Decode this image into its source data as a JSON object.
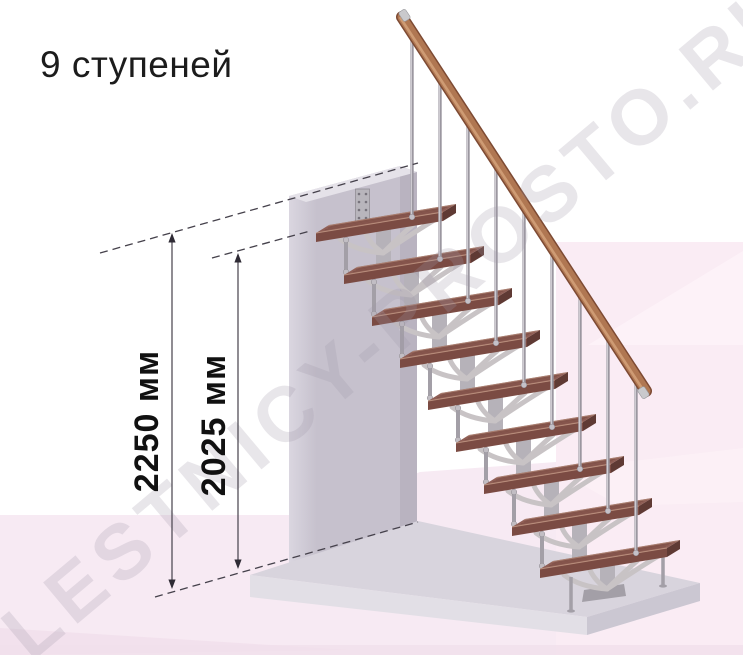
{
  "title": "9 ступеней",
  "watermark": "LESTNICY-PROSTO.RU",
  "dimensions": {
    "total_height": "2250 мм",
    "steps_height": "2025 мм"
  },
  "stairs": {
    "step_count": 9,
    "handrail": "wood",
    "frame": "metal-modular"
  },
  "colors": {
    "background": "#ffffff",
    "floor_pink_left": "#f7eaf3",
    "floor_pink_right": "#faecf4",
    "floor_facet_light": "#fdf2f8",
    "floor_facet_band": "#fbf1f6",
    "floor_dark": "#f0dfeb",
    "wall_light": "#dad6e0",
    "wall_dark": "#c6c1cd",
    "wall_side": "#b9b3c0",
    "wall_top": "#e5e2e9",
    "platform_top": "#d8d4dd",
    "platform_front": "#e2dfe6",
    "platform_side": "#cbc7d2",
    "tread_top": "#8f5e55",
    "tread_back_highlight": "#b28a79",
    "tread_front": "#7b4b43",
    "tread_end": "#5f3a34",
    "tread_grain": "#6e4138",
    "tread_edge_light": "#c59b86",
    "metal": "#b6b2b9",
    "metal_arm": "#c8c3c5",
    "metal_leg": "#a39fa7",
    "baluster": "#9b97a0",
    "baluster_light": "#d7d4da",
    "plate": "#b8b5bc",
    "plate_hole": "#77737c",
    "rail_dark": "#7d4a33",
    "rail_main": "#b07752",
    "rail_light": "#d2a078",
    "rail_cap": "#c9c9cc",
    "dim_line": "#45414b",
    "dim_arrow": "#2f2b35"
  }
}
